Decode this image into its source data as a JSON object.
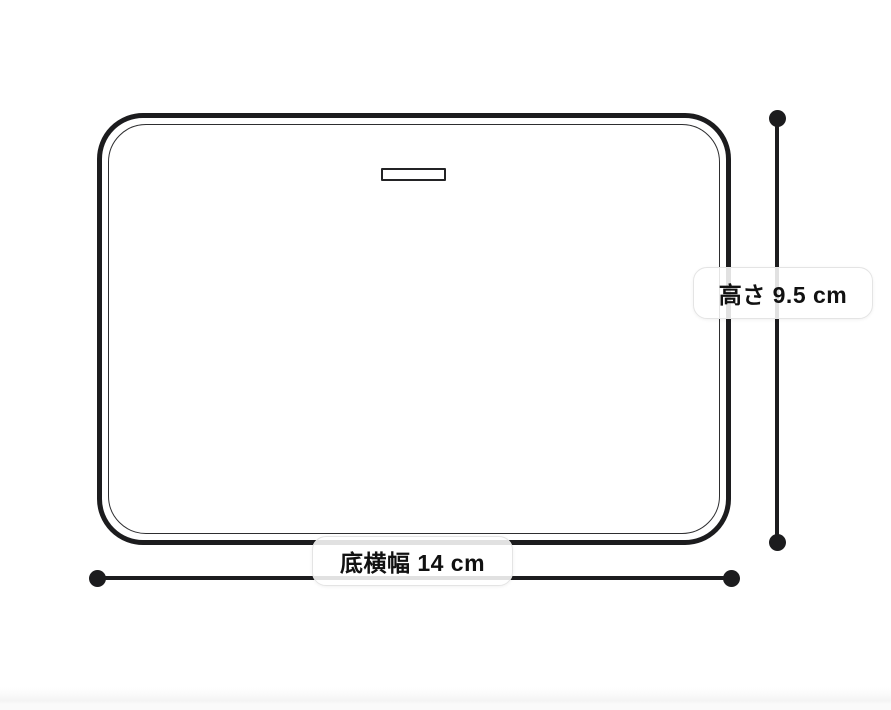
{
  "page": {
    "background": "#ffffff"
  },
  "diagram": {
    "type": "product-dimension-diagram",
    "height_label": "高さ 9.5 cm",
    "width_label": "底横幅 14 cm",
    "dimensions": [
      {
        "name": "高さ",
        "value": "9.5 cm"
      },
      {
        "name": "底横幅",
        "value": "14 cm"
      }
    ],
    "colors": {
      "line": "#1c1c1e",
      "label_border": "#e4e4e4",
      "label_background": "#ffffff",
      "text": "#111111"
    }
  }
}
